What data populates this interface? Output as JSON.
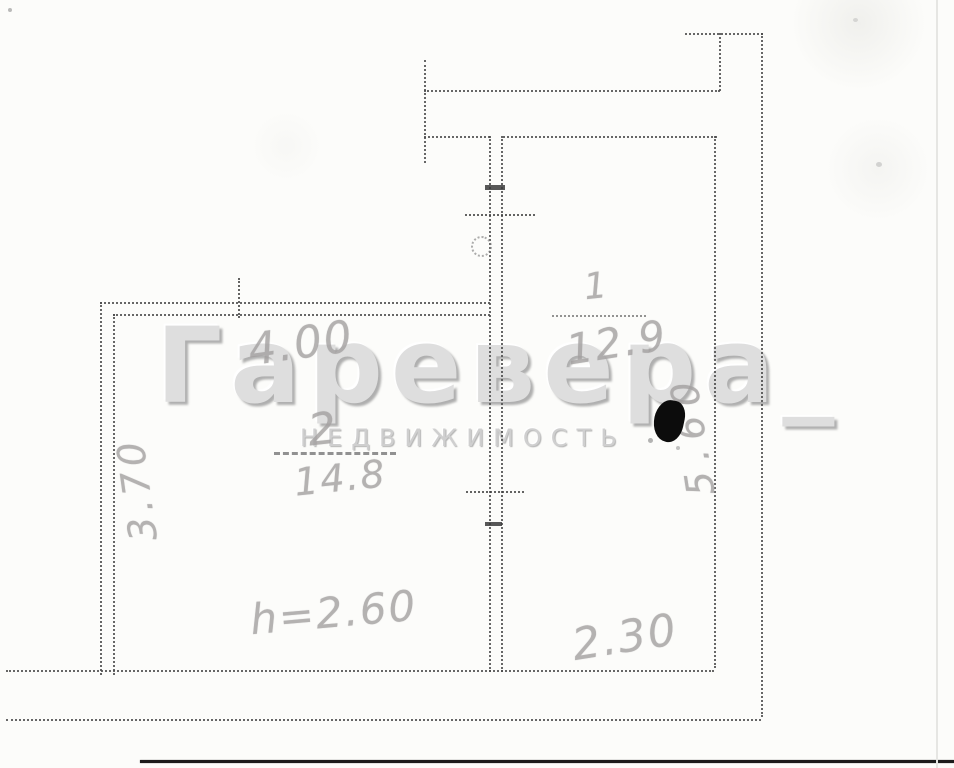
{
  "watermark": {
    "brand": "Гаревера_",
    "subtitle": "НЕДВИЖИМОСТЬ"
  },
  "rooms": {
    "room1": {
      "number": "1",
      "area": "12.9"
    },
    "room2": {
      "number": "2",
      "area": "14.8"
    }
  },
  "dimensions": {
    "room2_width": "4.00",
    "room2_depth": "3.70",
    "room1_width": "2.30",
    "room1_depth": "5.60",
    "ceiling_height": "h=2.60"
  },
  "colors": {
    "paper": "#fcfcfa",
    "wall_line": "#4b4b4b",
    "handwriting": "#a3a0a0",
    "watermark": "#dedede",
    "ink_blot": "#0c0c0c"
  }
}
